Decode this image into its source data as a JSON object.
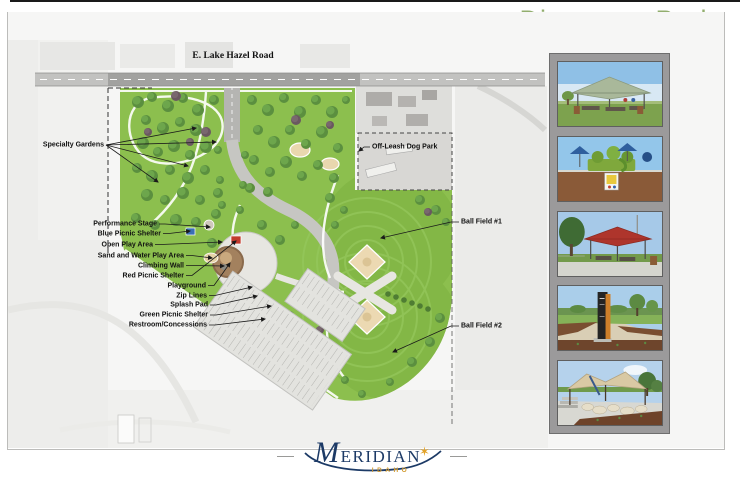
{
  "header": {
    "title": "Discovery Park"
  },
  "map": {
    "road_label": "E. Lake Hazel Road",
    "labels": {
      "specialty_gardens": "Specialty Gardens",
      "off_leash_dog_park": "Off-Leash Dog Park",
      "ball_field_1": "Ball Field #1",
      "ball_field_2": "Ball Field #2"
    },
    "amenity_labels": [
      "Performance Stage",
      "Blue Picnic Shelter",
      "Open Play Area",
      "Sand and Water Play Area",
      "Climbing Wall",
      "Red Picnic Shelter",
      "Playground",
      "Zip Lines",
      "Splash Pad",
      "Green Picnic Shelter",
      "Restroom/Concessions"
    ]
  },
  "photos": [
    {
      "name": "photo-picnic-shelter-green-roof"
    },
    {
      "name": "photo-playground-shade-umbrellas"
    },
    {
      "name": "photo-picnic-shelter-red-roof"
    },
    {
      "name": "photo-park-entry-sign-pillar"
    },
    {
      "name": "photo-stage-shade-canopy"
    }
  ],
  "logo": {
    "name": "MERIDIAN",
    "state": "IDAHO"
  },
  "colors": {
    "title_green": "#92ae6e",
    "underline_gray": "#5e5e5e",
    "park_green": "#8cbf4e",
    "field_green": "#83b746",
    "strip_gray": "#9b9a9b",
    "logo_navy": "#1c3a66",
    "logo_gold": "#d29a2e"
  }
}
